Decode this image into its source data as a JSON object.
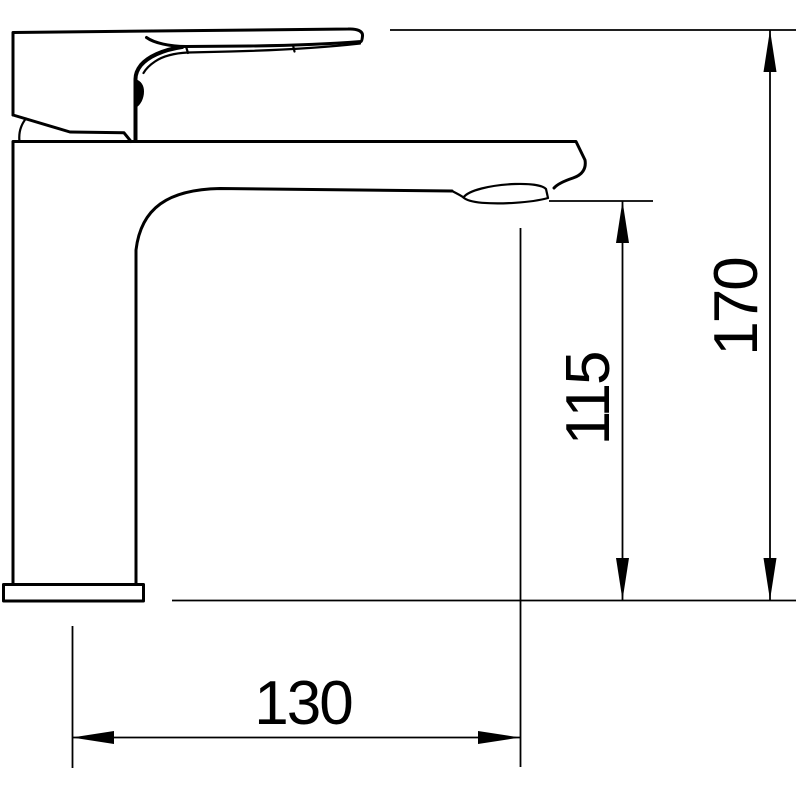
{
  "drawing": {
    "background_color": "#ffffff",
    "line_color": "#000000",
    "dimensions": {
      "total_height": {
        "value": "170",
        "orientation": "vertical"
      },
      "spout_height": {
        "value": "115",
        "orientation": "vertical"
      },
      "spout_reach": {
        "value": "130",
        "orientation": "horizontal"
      }
    }
  }
}
